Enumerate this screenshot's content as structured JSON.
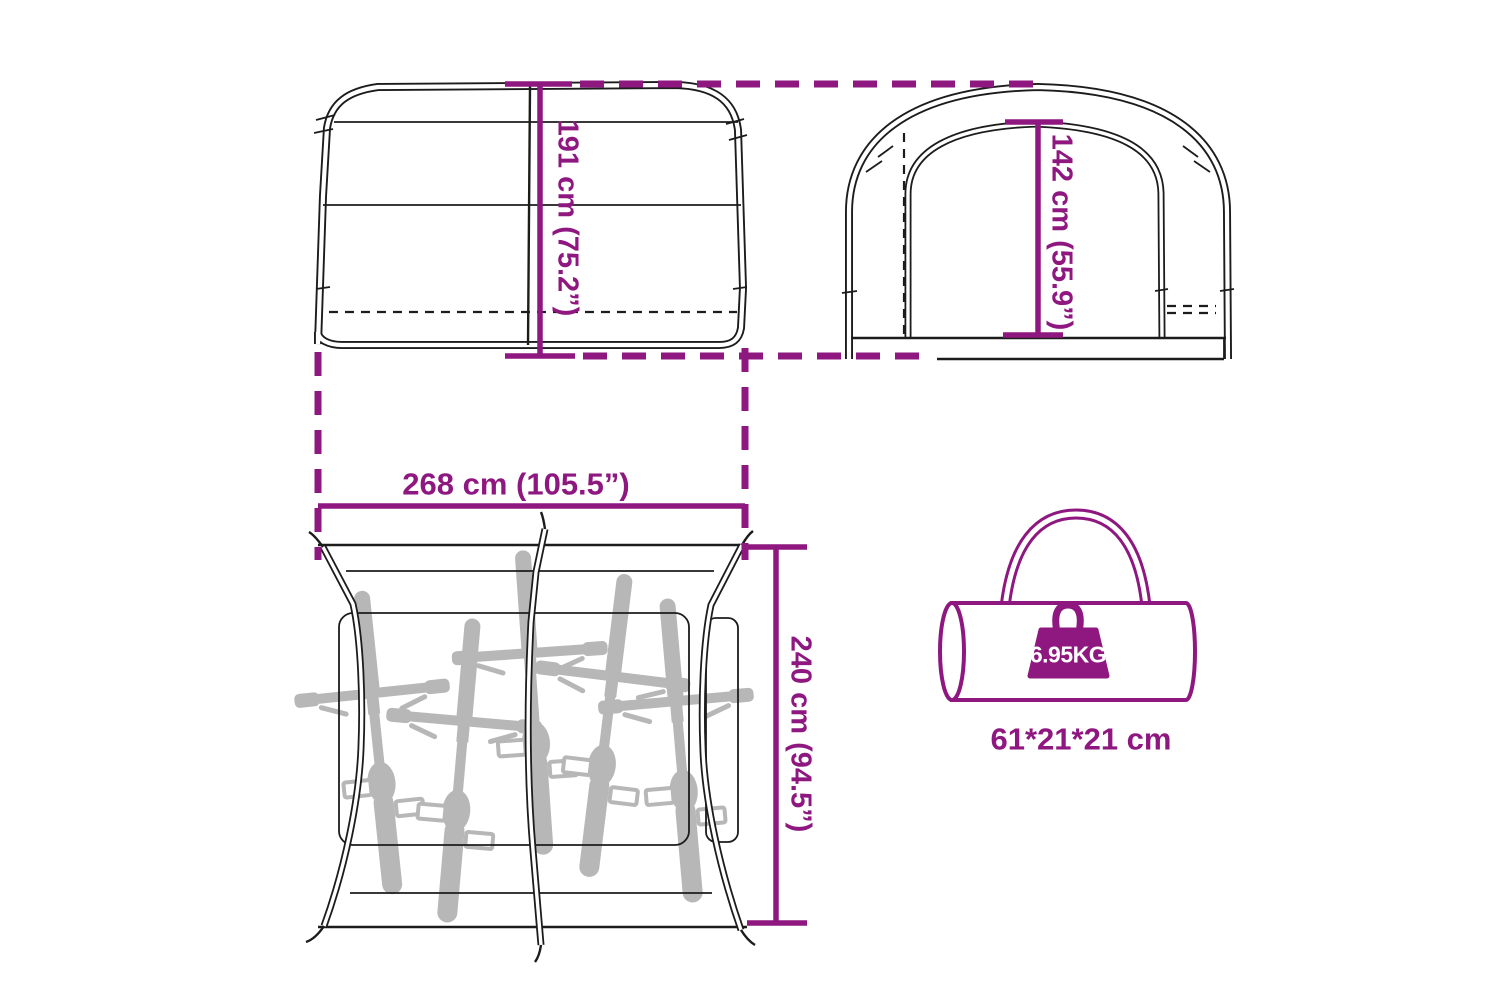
{
  "diagram": {
    "type": "product-dimension-diagram",
    "subject": "bike storage tent with five bikes and carry bag",
    "colors": {
      "accent": "#8e1880",
      "line": "#1c1c1c",
      "bike": "#b7b7b7",
      "white": "#ffffff"
    },
    "views": {
      "side": {
        "name": "side view",
        "height_label": "191 cm (75.2”)"
      },
      "front": {
        "name": "front view",
        "inner_height_label": "142 cm (55.9”)"
      },
      "top": {
        "name": "top view",
        "width_label": "268 cm (105.5”)",
        "depth_label": "240 cm (94.5”)",
        "bike_count": 5
      },
      "bag": {
        "name": "carry bag",
        "weight_label": "6.95KG",
        "size_label": "61*21*21 cm"
      }
    }
  }
}
